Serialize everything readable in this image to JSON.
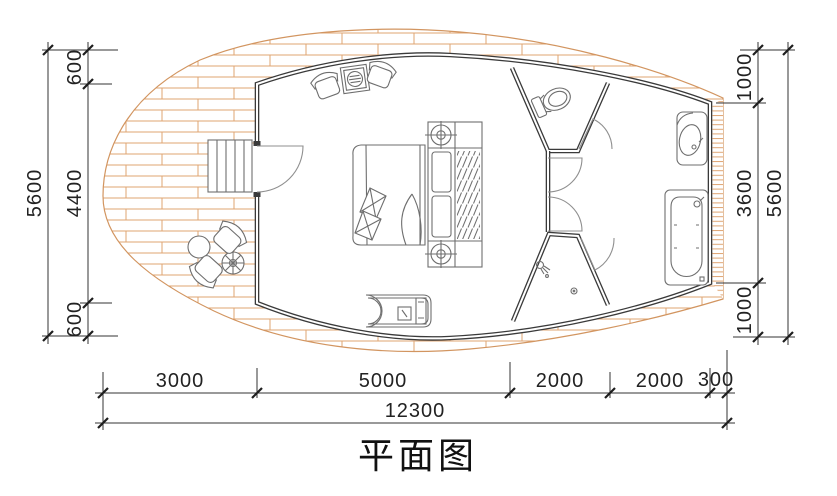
{
  "title": "平面图",
  "dims": {
    "left": {
      "segments": [
        "600",
        "4400",
        "600"
      ],
      "total": "5600"
    },
    "right": {
      "segments": [
        "1000",
        "3600",
        "1000"
      ],
      "total": "5600"
    },
    "bottom": {
      "segments": [
        "3000",
        "5000",
        "2000",
        "2000",
        "300"
      ],
      "total": "12300"
    }
  },
  "colors": {
    "deck_hatch": "#dfa472",
    "deck_edge": "#d29560",
    "wall": "#3a3a3a",
    "furniture": "#6e6e6e",
    "dimension": "#222222"
  }
}
